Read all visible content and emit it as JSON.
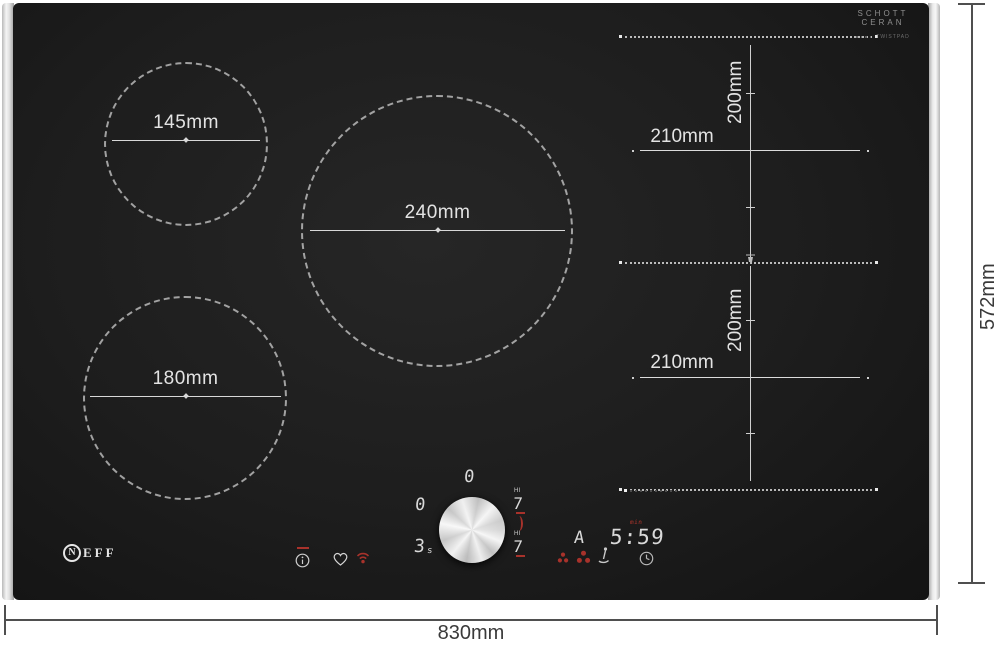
{
  "branding": {
    "schott_line1": "SCHOTT",
    "schott_line2": "CERAN",
    "schott_subtext": "TWISTPAD",
    "neff_initial": "N",
    "neff_letters": "EFF"
  },
  "zones": {
    "zone_145_label": "145mm",
    "zone_240_label": "240mm",
    "zone_180_label": "180mm",
    "flex_top": {
      "width_label": "210mm",
      "height_label": "200mm"
    },
    "flex_bottom": {
      "width_label": "210mm",
      "height_label": "200mm"
    }
  },
  "outer_dimensions": {
    "width_label": "830mm",
    "height_label": "572mm"
  },
  "control_panel": {
    "aux_display_top": "0",
    "aux_display_left": "0",
    "boost_value": "3",
    "boost_unit": "s",
    "right_level_top": {
      "hi_label": "HI",
      "value": "7"
    },
    "right_level_bottom": {
      "hi_label": "HI",
      "value": "7"
    },
    "auto_display": "A",
    "timer_value": "5:59",
    "timer_unit": "min"
  },
  "icons": {
    "info": "info-circle",
    "favorite": "heart-outline",
    "home_connect": "wifi",
    "power_left": "petal-cluster",
    "power_right": "petal-cluster",
    "cooking_sensor": "temperature-probe",
    "timer": "clock",
    "flex_junction": "pan-marker"
  },
  "colors": {
    "glass": "#1d1d1d",
    "accent_red": "#a8322b",
    "display_white": "#d9d9d9",
    "trim_silver": "#e2e2e2",
    "dimension_text_dark": "#3a3a3a",
    "dimension_text_light": "#e3e3e3"
  }
}
